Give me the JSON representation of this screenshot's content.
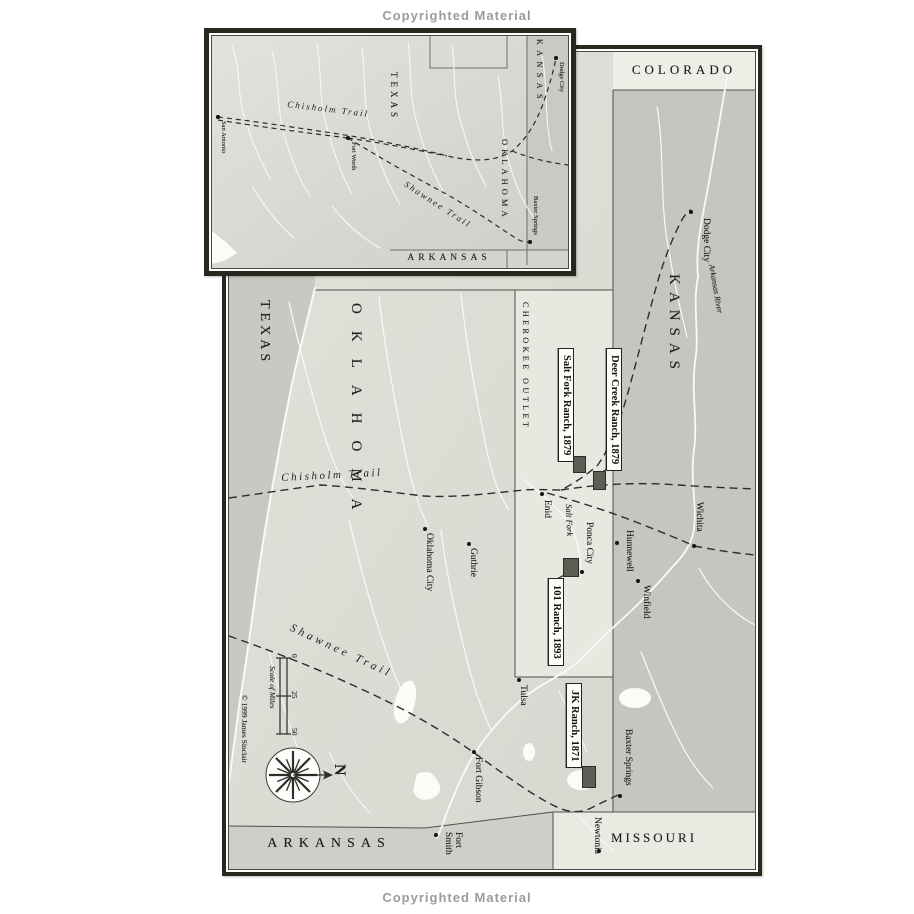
{
  "page": {
    "copyright_top": "Copyrighted Material",
    "copyright_bottom": "Copyrighted Material"
  },
  "inset_map": {
    "states": {
      "texas": "TEXAS",
      "kansas": "KANSAS",
      "oklahoma": "OKLAHOMA",
      "arkansas": "ARKANSAS"
    },
    "cities": [
      {
        "name": "San Antonio"
      },
      {
        "name": "Fort Worth"
      },
      {
        "name": "Dodge City"
      },
      {
        "name": "Baxter Springs"
      }
    ],
    "trails": {
      "chisholm": "Chisholm Trail",
      "shawnee": "Shawnee Trail"
    }
  },
  "main_map": {
    "states": {
      "colorado": "COLORADO",
      "kansas": "KANSAS",
      "texas": "TEXAS",
      "oklahoma": "OKLAHOMA",
      "missouri": "MISSOURI",
      "arkansas": "ARKANSAS"
    },
    "regions": {
      "cherokee_outlet": "CHEROKEE OUTLET"
    },
    "cities": [
      {
        "name": "Dodge City"
      },
      {
        "name": "Wichita"
      },
      {
        "name": "Hunnewell"
      },
      {
        "name": "Winfield"
      },
      {
        "name": "Enid"
      },
      {
        "name": "Ponca City"
      },
      {
        "name": "Oklahoma City"
      },
      {
        "name": "Guthrie"
      },
      {
        "name": "Tulsa"
      },
      {
        "name": "Fort Gibson"
      },
      {
        "name": "Baxter Springs"
      },
      {
        "name": "Fort Smith"
      },
      {
        "name": "Newtonia"
      }
    ],
    "rivers": {
      "arkansas_river": "Arkansas River",
      "salt_fork": "Salt Fork"
    },
    "trails": {
      "chisholm": "Chisholm Trail",
      "shawnee": "Shawnee Trail"
    },
    "ranches": [
      {
        "label": "Salt Fork Ranch, 1879"
      },
      {
        "label": "Deer Creek Ranch, 1879"
      },
      {
        "label": "101 Ranch, 1893"
      },
      {
        "label": "JK Ranch, 1871"
      }
    ],
    "scale": {
      "label": "Scale of Miles",
      "ticks": [
        "0",
        "25",
        "50"
      ]
    },
    "compass": {
      "north": "N"
    },
    "credit": "© 1999 James Sinclair"
  },
  "colors": {
    "paper": "#ffffff",
    "frame": "#29281f",
    "texas": "#c9c8c2",
    "oklahoma": "#deddd6",
    "cherokee_outlet": "#e8e7e0",
    "kansas": "#c6c5c0",
    "colorado": "#eeede6",
    "missouri": "#eae9e2",
    "arkansas": "#cfcec8",
    "river": "#f9f9f6",
    "trail": "#2d2d29",
    "ranch_marker": "#5d5c55",
    "copyright_text": "#9b9b9b"
  }
}
